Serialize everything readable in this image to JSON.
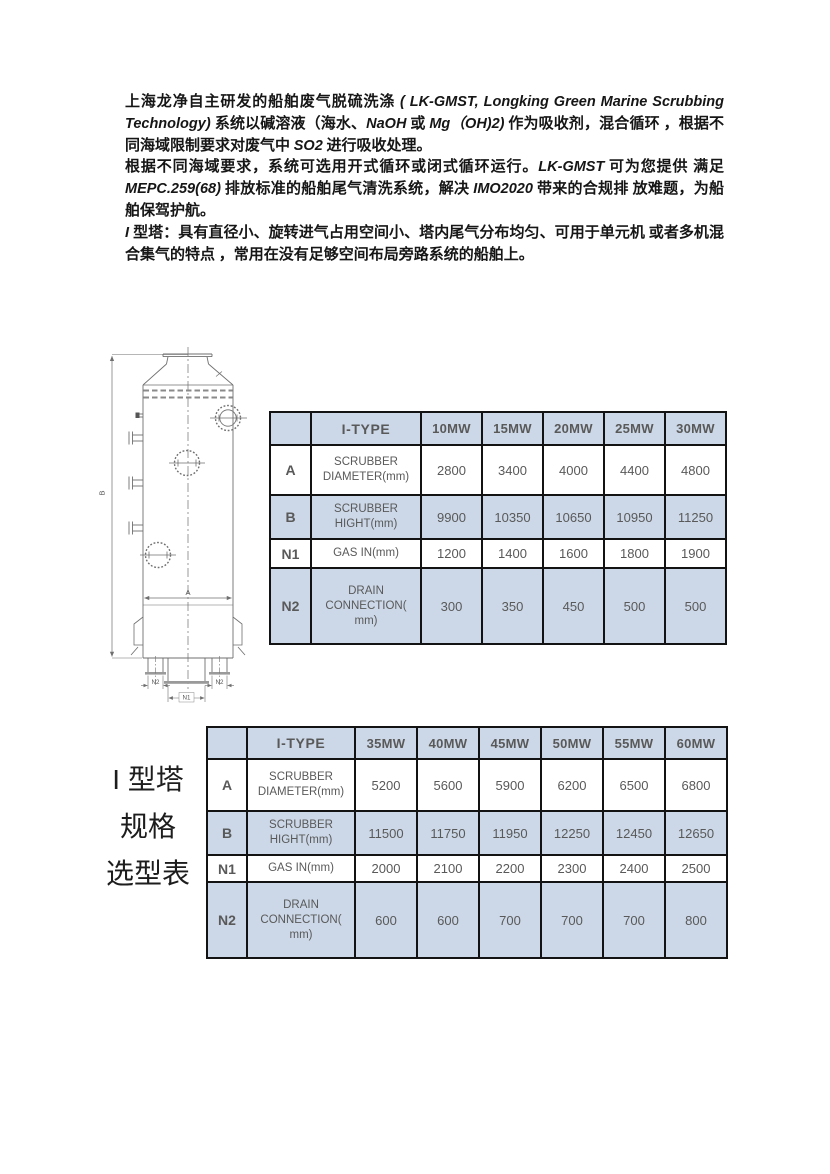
{
  "document": {
    "paragraphs": [
      {
        "runs": [
          {
            "style": "cn",
            "text": "上海龙净自主研发的船舶废气脱硫洗涤 "
          },
          {
            "style": "latin",
            "text": "( LK-GMST, Longking Green Marine Scrubbing Technology) "
          },
          {
            "style": "cn",
            "text": "系统以碱溶液（海水、"
          },
          {
            "style": "latin",
            "text": "NaOH"
          },
          {
            "style": "cn",
            "text": " 或 "
          },
          {
            "style": "latin",
            "text": "Mg（OH)2)"
          },
          {
            "style": "cn",
            "text": " 作为吸收剂，混合循环 ，根据不同海域限制要求对废气中 "
          },
          {
            "style": "latin",
            "text": "SO2"
          },
          {
            "style": "cn",
            "text": " 进行吸收处理。"
          }
        ]
      },
      {
        "runs": [
          {
            "style": "cn",
            "text": "根据不同海域要求，系统可选用开式循环或闭式循环运行。"
          },
          {
            "style": "latin",
            "text": "LK-GMST"
          },
          {
            "style": "cn",
            "text": " 可为您提供 满足 "
          },
          {
            "style": "latin",
            "text": "MEPC.259(68)"
          },
          {
            "style": "cn",
            "text": " 排放标准的船舶尾气清洗系统，解决 "
          },
          {
            "style": "latin",
            "text": "IMO2020"
          },
          {
            "style": "cn",
            "text": " 带来的合规排 放难题，为船舶保驾护航。"
          }
        ]
      },
      {
        "runs": [
          {
            "style": "latin",
            "text": "I "
          },
          {
            "style": "cnb",
            "text": "型塔："
          },
          {
            "style": "cn",
            "text": "具有直径小、旋转进气占用空间小、塔内尾气分布均匀、可用于单元机 或者多机混合集气的特点 ，常用在没有足够空间布局旁路系统的船舶上。"
          }
        ]
      }
    ],
    "diagram": {
      "dim_width_label": "A",
      "dim_height_label": "B",
      "gas_in_label": "N1",
      "drain_label": "N2"
    },
    "tables": [
      {
        "corner": "",
        "type_header": "I-TYPE",
        "columns": [
          "10MW",
          "15MW",
          "20MW",
          "25MW",
          "30MW"
        ],
        "rows": [
          {
            "key": "A",
            "label": "SCRUBBER DIAMETER(mm)",
            "values": [
              "2800",
              "3400",
              "4000",
              "4400",
              "4800"
            ]
          },
          {
            "key": "B",
            "label": "SCRUBBER HIGHT(mm)",
            "values": [
              "9900",
              "10350",
              "10650",
              "10950",
              "11250"
            ]
          },
          {
            "key": "N1",
            "label": "GAS IN(mm)",
            "values": [
              "1200",
              "1400",
              "1600",
              "1800",
              "1900"
            ]
          },
          {
            "key": "N2",
            "label": "DRAIN CONNECTION( mm)",
            "values": [
              "300",
              "350",
              "450",
              "500",
              "500"
            ]
          }
        ]
      },
      {
        "corner": "",
        "type_header": "I-TYPE",
        "columns": [
          "35MW",
          "40MW",
          "45MW",
          "50MW",
          "55MW",
          "60MW"
        ],
        "rows": [
          {
            "key": "A",
            "label": "SCRUBBER DIAMETER(mm)",
            "values": [
              "5200",
              "5600",
              "5900",
              "6200",
              "6500",
              "6800"
            ]
          },
          {
            "key": "B",
            "label": "SCRUBBER HIGHT(mm)",
            "values": [
              "11500",
              "11750",
              "11950",
              "12250",
              "12450",
              "12650"
            ]
          },
          {
            "key": "N1",
            "label": "GAS IN(mm)",
            "values": [
              "2000",
              "2100",
              "2200",
              "2300",
              "2400",
              "2500"
            ]
          },
          {
            "key": "N2",
            "label": "DRAIN CONNECTION( mm)",
            "values": [
              "600",
              "600",
              "700",
              "700",
              "700",
              "800"
            ]
          }
        ]
      }
    ],
    "side_label": {
      "lines": [
        "I 型塔",
        "规格",
        "选型表"
      ]
    },
    "colors": {
      "table_shaded": "#ccd8e7",
      "table_border": "#131313",
      "table_text": "#595959",
      "drawing_line": "#6f6f6f"
    }
  }
}
